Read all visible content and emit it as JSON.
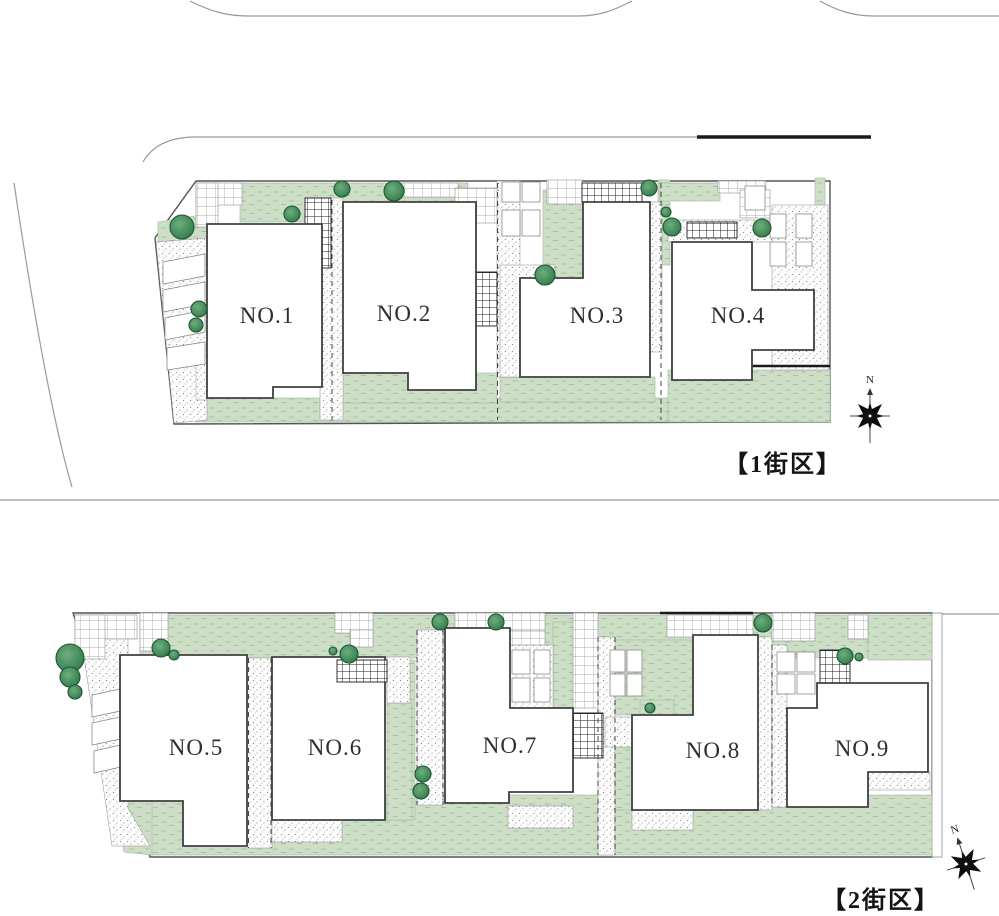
{
  "plan": {
    "blocks": [
      {
        "name": "block-1",
        "label": "【1街区】",
        "lots": [
          {
            "label": "NO.1"
          },
          {
            "label": "NO.2"
          },
          {
            "label": "NO.3"
          },
          {
            "label": "NO.4"
          }
        ]
      },
      {
        "name": "block-2",
        "label": "【2街区】",
        "lots": [
          {
            "label": "NO.5"
          },
          {
            "label": "NO.6"
          },
          {
            "label": "NO.7"
          },
          {
            "label": "NO.8"
          },
          {
            "label": "NO.9"
          }
        ]
      }
    ],
    "compass": {
      "north_label": "N"
    },
    "colors": {
      "lawn": "#cddec7",
      "lawn_dash": "#a7c19f",
      "tree": "#2f7a49",
      "tree_light": "#6fae7e",
      "house_outline": "#404040",
      "site_outline": "#555555",
      "road": "#9a9a9a",
      "wall": "#1a1a1a",
      "label": "#2e2e31"
    }
  }
}
